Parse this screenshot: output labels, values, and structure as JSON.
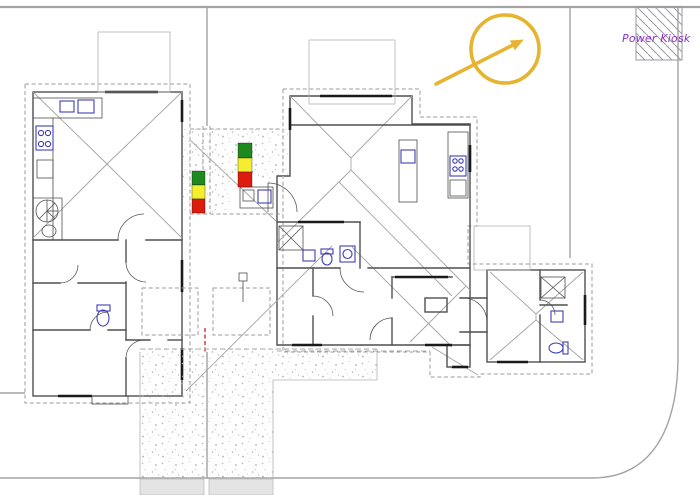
{
  "canvas": {
    "width": 700,
    "height": 495,
    "background": "#ffffff",
    "type": "architectural-site-plan"
  },
  "labels": {
    "power_kiosk": "Power Kiosk"
  },
  "colors": {
    "boundary": "#a3a3a3",
    "wall": "#4f4f4f",
    "eave": "#9b9b9b",
    "roof": "#a4a4a4",
    "window": "#1a1a1a",
    "fixture": "#3f3fb4",
    "stipple": "#b0b0b0",
    "hatch": "#9a9aa6",
    "kiosk_text": "#8a2fc4",
    "annotation_yellow": "#e6b431",
    "marker_green": "#1e8a1e",
    "marker_yellow": "#f4ee2e",
    "marker_red": "#dd1c10",
    "road_fill": "#e4e4e4",
    "red_dash": "#cc2020"
  },
  "annotations": {
    "power_kiosk": {
      "text": "Power Kiosk",
      "x": 622,
      "y": 42
    },
    "direction_circle_arrow": {
      "shape": "circle-with-arrow",
      "cx": 505,
      "cy": 49,
      "r": 34,
      "arrow_from": [
        436,
        84
      ],
      "arrow_to": [
        521,
        41
      ]
    },
    "issue_markers": [
      {
        "id": "marker-1",
        "x": 192,
        "y": 171,
        "stack": [
          "green",
          "yellow",
          "red"
        ]
      },
      {
        "id": "marker-2",
        "x": 238,
        "y": 143,
        "stack": [
          "green",
          "yellow",
          "red"
        ]
      }
    ]
  }
}
